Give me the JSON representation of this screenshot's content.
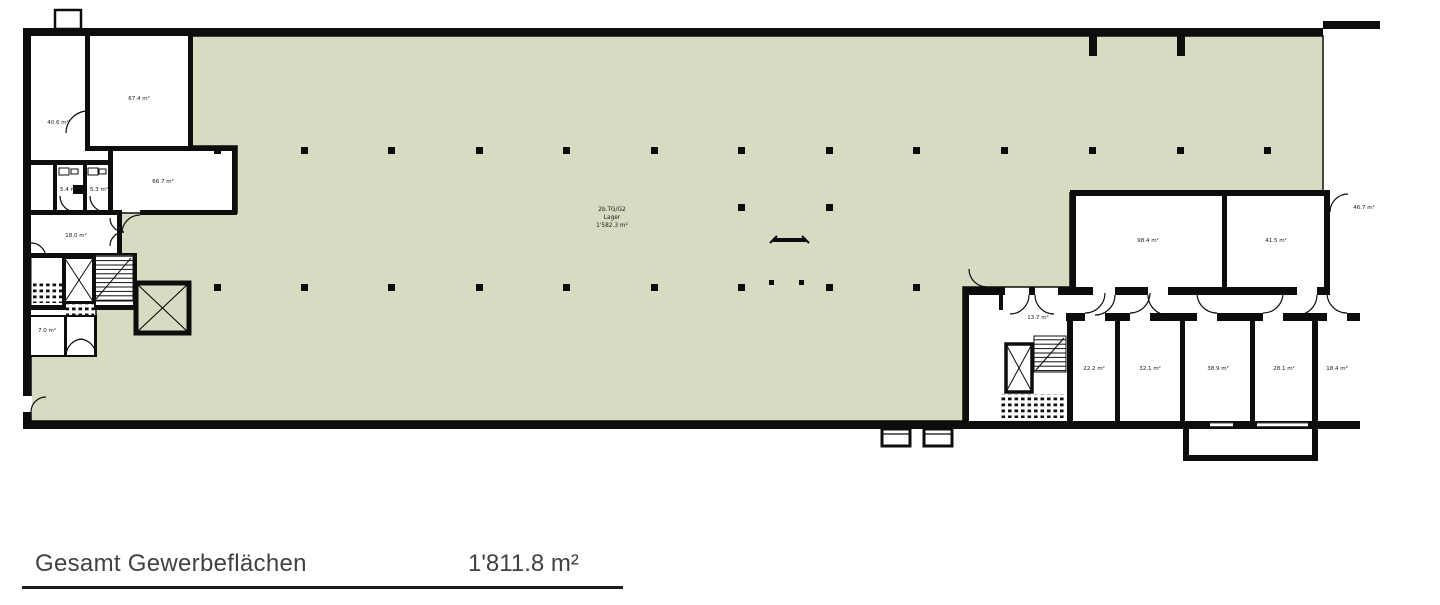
{
  "plan": {
    "colors": {
      "hall_fill": "#d6dbc2",
      "wall": "#0d0d0d",
      "label_text": "#1a1a1a"
    },
    "hall_label": {
      "code": "2b.TG/G2",
      "name": "Lager",
      "area": "1'582.3 m²"
    },
    "rooms": {
      "r1": "40.6 m²",
      "r2": "67.4 m²",
      "r3": "66.7 m²",
      "wc1": "5.4 m²",
      "wc2": "5.3 m²",
      "r4": "18.0 m²",
      "r5": "7.0 m²",
      "k1": "13.7 m²",
      "big1": "98.4 m²",
      "big2": "41.5 m²",
      "s1": "22.2 m²",
      "s2": "32.1 m²",
      "s3": "38.9 m²",
      "s4": "28.1 m²",
      "s5": "18.4 m²",
      "out1": "46.7 m²"
    }
  },
  "legend": {
    "label": "Gesamt Gewerbeflächen",
    "value": "1'811.8 m²"
  }
}
